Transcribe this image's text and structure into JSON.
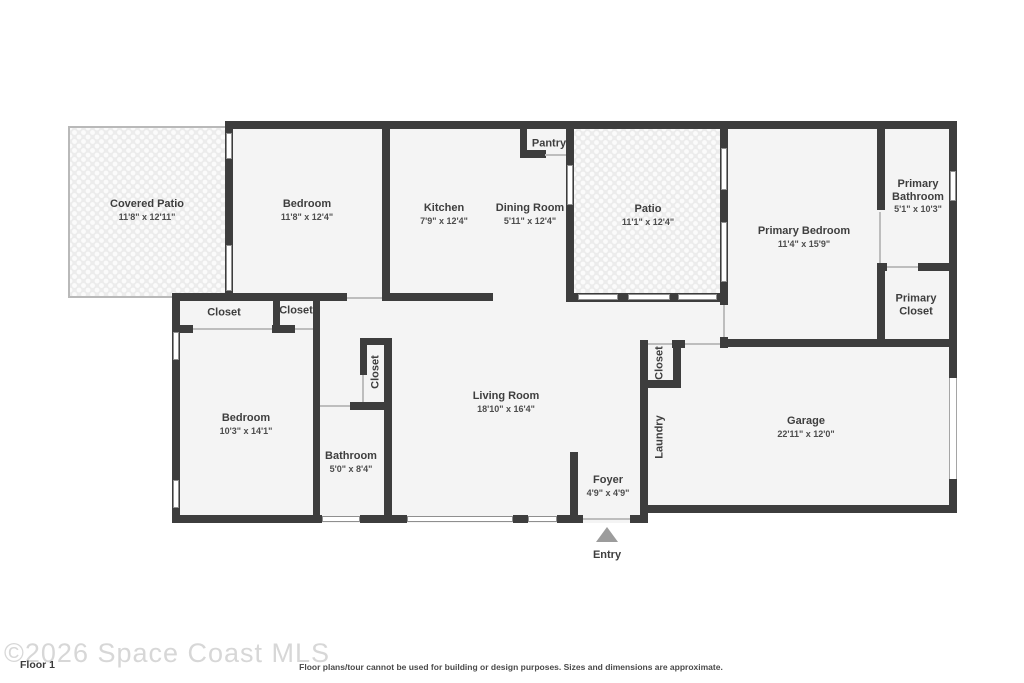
{
  "floorplan": {
    "rooms": [
      {
        "id": "covered-patio",
        "label": "Covered Patio",
        "dims": "11'8\" x 12'11\""
      },
      {
        "id": "bedroom-top",
        "label": "Bedroom",
        "dims": "11'8\" x 12'4\""
      },
      {
        "id": "kitchen",
        "label": "Kitchen",
        "dims": "7'9\" x 12'4\""
      },
      {
        "id": "dining-room",
        "label": "Dining Room",
        "dims": "5'11\" x 12'4\""
      },
      {
        "id": "pantry",
        "label": "Pantry",
        "dims": ""
      },
      {
        "id": "patio",
        "label": "Patio",
        "dims": "11'1\" x 12'4\""
      },
      {
        "id": "primary-bedroom",
        "label": "Primary Bedroom",
        "dims": "11'4\" x 15'9\""
      },
      {
        "id": "primary-bathroom",
        "label": "Primary Bathroom",
        "dims": "5'1\" x 10'3\""
      },
      {
        "id": "primary-closet",
        "label": "Primary Closet",
        "dims": ""
      },
      {
        "id": "closet-1",
        "label": "Closet",
        "dims": ""
      },
      {
        "id": "closet-2",
        "label": "Closet",
        "dims": ""
      },
      {
        "id": "bedroom-bottom",
        "label": "Bedroom",
        "dims": "10'3\" x 14'1\""
      },
      {
        "id": "closet-hall",
        "label": "Closet",
        "dims": ""
      },
      {
        "id": "bathroom",
        "label": "Bathroom",
        "dims": "5'0\" x 8'4\""
      },
      {
        "id": "living-room",
        "label": "Living Room",
        "dims": "18'10\" x 16'4\""
      },
      {
        "id": "laundry-closet",
        "label": "Closet",
        "dims": ""
      },
      {
        "id": "laundry",
        "label": "Laundry",
        "dims": ""
      },
      {
        "id": "foyer",
        "label": "Foyer",
        "dims": "4'9\" x 4'9\""
      },
      {
        "id": "garage",
        "label": "Garage",
        "dims": "22'11\" x 12'0\""
      }
    ],
    "entry_label": "Entry"
  },
  "footer": {
    "watermark": "©2026 Space Coast MLS",
    "floor_label": "Floor 1",
    "disclaimer": "Floor plans/tour cannot be used for building or design purposes. Sizes and dimensions are approximate."
  },
  "colors": {
    "wall": "#3d3d3d",
    "room_fill": "#f4f4f4",
    "door_line": "#bdbdbd",
    "entry_arrow": "#9c9c9c",
    "watermark_text": "#d7d7d7"
  }
}
